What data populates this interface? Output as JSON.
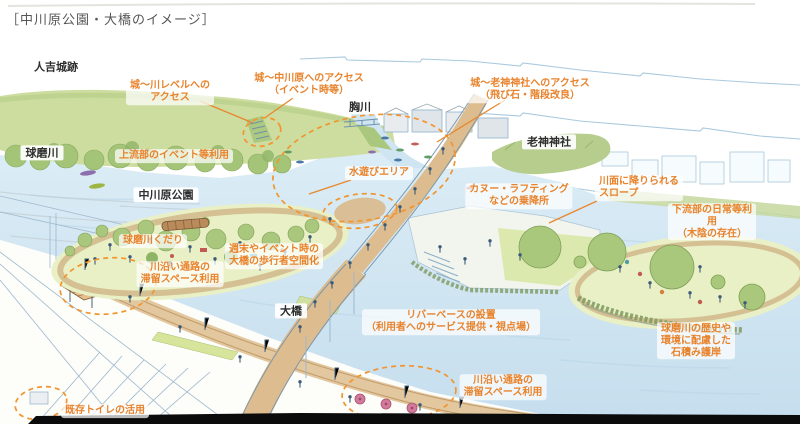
{
  "title": "［中川原公園・大橋のイメージ］",
  "place_labels": {
    "hitoyoshi_castle_ruins": "人吉城跡",
    "muneagawa_river": "胸川",
    "oigami_shrine": "老神神社",
    "kumagawa_river": "球磨川",
    "nakagawara_park": "中川原公園",
    "ohashi_bridge": "大橋"
  },
  "annotations": {
    "access_castle_to_river": "城〜川レベルへの\nアクセス",
    "access_castle_to_nakagawara": "城〜中川原へのアクセス\n（イベント時等）",
    "access_castle_to_shrine": "城〜老神神社へのアクセス\n（飛び石・階段改良）",
    "upstream_event_use": "上流部のイベント等利用",
    "water_play_area": "水遊びエリア",
    "canoe_rafting_landing": "カヌー・ラフティング\nなどの乗降所",
    "slope_to_water": "川面に降りられる\nスロープ",
    "downstream_daily_use": "下流部の日常等利用\n（木陰の存在）",
    "kumagawa_kudari_boat": "球磨川くだり",
    "weekend_pedestrian_bridge": "週末やイベント時の\n大橋の歩行者空間化",
    "riverside_stay_space_left": "川沿い通路の\n滞留スペース利用",
    "river_base": "リバーベースの設置\n（利用者へのサービス提供・視点場）",
    "riverside_stay_space_right": "川沿い通路の\n滞留スペース利用",
    "stone_revetment": "球磨川の歴史や\n環境に配慮した\n石積み護岸",
    "existing_toilet_use": "既存トイレの活用"
  },
  "colors": {
    "annotation_orange": "#e8832c",
    "highlight_dash_orange": "#f2952f",
    "place_label_black": "#2e2e2e",
    "water_blue": "#cfe3f0",
    "park_green": "#e9f0c6",
    "tree_green": "#a9c77d",
    "bridge_tan": "#ddbd8f"
  }
}
